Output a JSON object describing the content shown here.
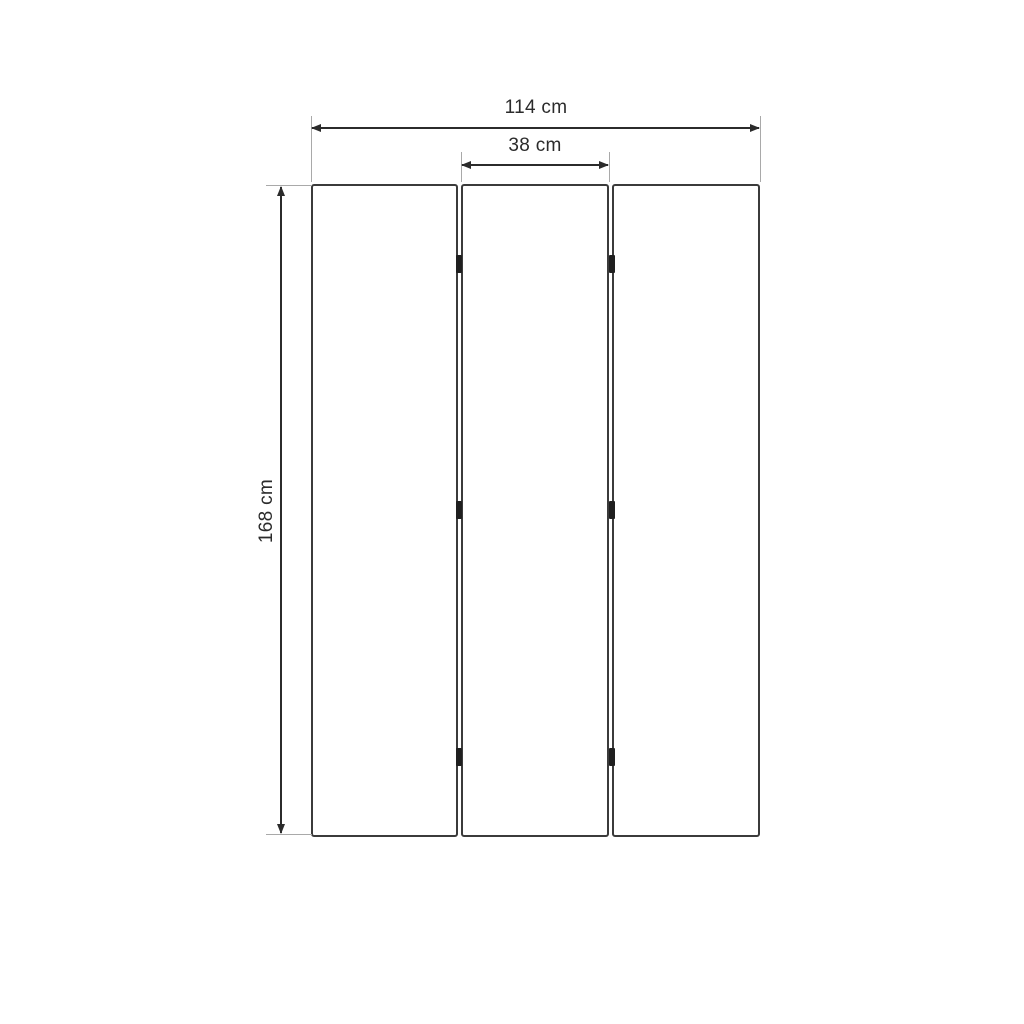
{
  "diagram": {
    "kind": "dimension-drawing",
    "subject": "three-panel folding screen, front view",
    "dimensions": {
      "total_width": "114 cm",
      "panel_width": "38 cm",
      "height": "168 cm"
    },
    "panel_count": 3,
    "hinge_count": 6,
    "colors": {
      "background": "#ffffff",
      "panel_border": "#3b3b3b",
      "dimension_line": "#2b2b2b",
      "extension_line": "#a9a9a9",
      "hinge": "#1f1f1f",
      "text": "#2b2b2b"
    }
  }
}
